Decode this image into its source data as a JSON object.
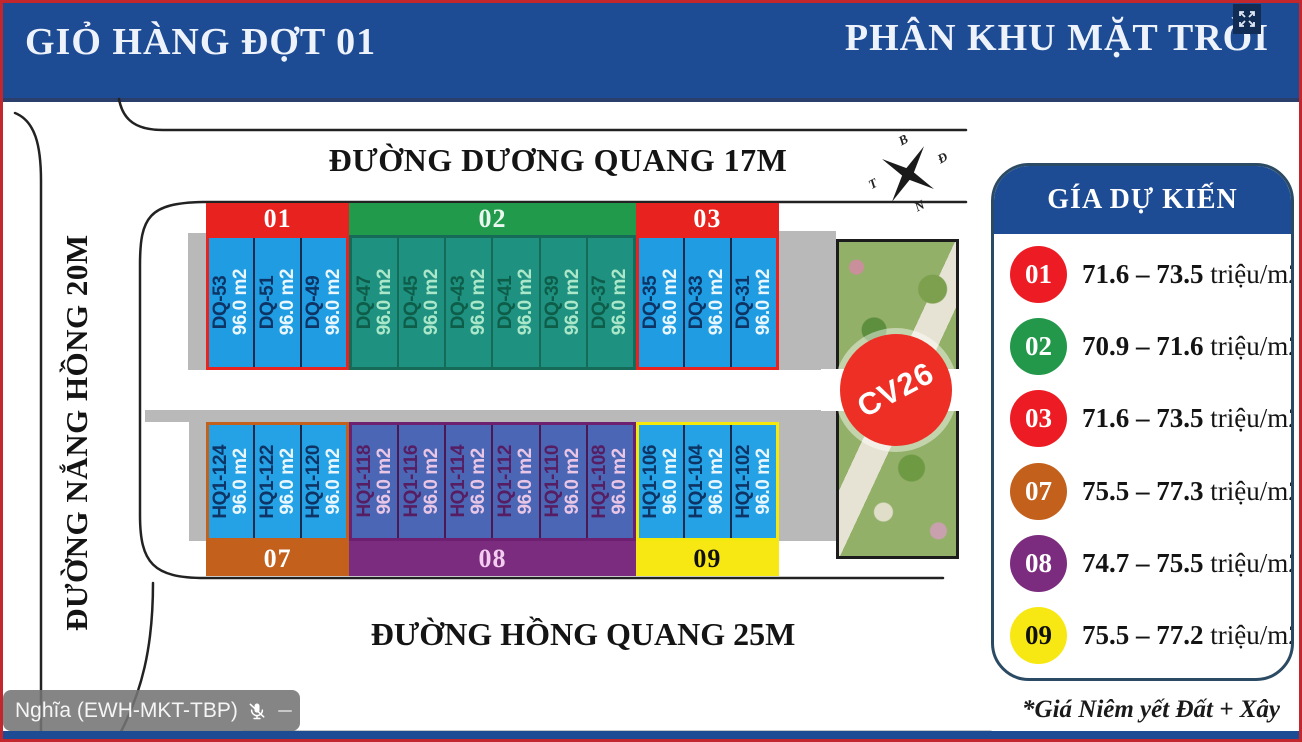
{
  "header": {
    "left_title": "GIỎ HÀNG ĐỢT 01",
    "right_title": "PHÂN KHU MẶT TRỜI"
  },
  "streets": {
    "top": "ĐƯỜNG DƯƠNG QUANG 17M",
    "left": "ĐƯỜNG NẮNG HỒNG 20M",
    "bottom": "ĐƯỜNG HỒNG QUANG 25M"
  },
  "compass": {
    "top": "B",
    "right": "Đ",
    "bottom": "N",
    "left": "T"
  },
  "park": {
    "label": "CV26",
    "marker_color": "#ee2f25"
  },
  "blocks": {
    "row1": [
      {
        "id": "01",
        "header_color": "#e8221f",
        "header_text": "#ffffff",
        "plot_bg": "#1f9ce2",
        "code_color": "#0d3464",
        "area_color": "#eaf7ff",
        "border_color": "#e8221f",
        "divider": "#1a2c4e",
        "plots": [
          {
            "code": "DQ-53",
            "area": "96.0 m2"
          },
          {
            "code": "DQ-51",
            "area": "96.0 m2"
          },
          {
            "code": "DQ-49",
            "area": "96.0 m2"
          }
        ]
      },
      {
        "id": "02",
        "header_color": "#219a4b",
        "header_text": "#e9f7ee",
        "plot_bg": "#1f9180",
        "code_color": "#0e5d49",
        "area_color": "#abe7c9",
        "border_color": "#156b57",
        "divider": "#156b57",
        "plots": [
          {
            "code": "DQ-47",
            "area": "96.0 m2"
          },
          {
            "code": "DQ-45",
            "area": "96.0 m2"
          },
          {
            "code": "DQ-43",
            "area": "96.0 m2"
          },
          {
            "code": "DQ-41",
            "area": "96.0 m2"
          },
          {
            "code": "DQ-39",
            "area": "96.0 m2"
          },
          {
            "code": "DQ-37",
            "area": "96.0 m2"
          }
        ]
      },
      {
        "id": "03",
        "header_color": "#e8221f",
        "header_text": "#ffffff",
        "plot_bg": "#1f9ce2",
        "code_color": "#0d3464",
        "area_color": "#eaf7ff",
        "border_color": "#e8221f",
        "divider": "#1a2c4e",
        "plots": [
          {
            "code": "DQ-35",
            "area": "96.0 m2"
          },
          {
            "code": "DQ-33",
            "area": "96.0 m2"
          },
          {
            "code": "DQ-31",
            "area": "96.0 m2"
          }
        ]
      }
    ],
    "row2": [
      {
        "id": "07",
        "header_color": "#c2601c",
        "header_text": "#ffffff",
        "plot_bg": "#25a2e5",
        "code_color": "#0d3464",
        "area_color": "#eaf7ff",
        "border_color": "#c2601c",
        "divider": "#1a2c4e",
        "plots": [
          {
            "code": "HQ1-124",
            "area": "96.0 m2"
          },
          {
            "code": "HQ1-122",
            "area": "96.0 m2"
          },
          {
            "code": "HQ1-120",
            "area": "96.0 m2"
          }
        ]
      },
      {
        "id": "08",
        "header_color": "#7c2c7e",
        "header_text": "#f2cdef",
        "plot_bg": "#4b66b5",
        "code_color": "#571d62",
        "area_color": "#e9c6e6",
        "border_color": "#6d2070",
        "divider": "#4a1853",
        "plots": [
          {
            "code": "HQ1-118",
            "area": "96.0 m2"
          },
          {
            "code": "HQ1-116",
            "area": "96.0 m2"
          },
          {
            "code": "HQ1-114",
            "area": "96.0 m2"
          },
          {
            "code": "HQ1-112",
            "area": "96.0 m2"
          },
          {
            "code": "HQ1-110",
            "area": "96.0 m2"
          },
          {
            "code": "HQ1-108",
            "area": "96.0 m2"
          }
        ]
      },
      {
        "id": "09",
        "header_color": "#f7e813",
        "header_text": "#101010",
        "plot_bg": "#25a2e5",
        "code_color": "#0d3464",
        "area_color": "#eaf7ff",
        "border_color": "#f5e90c",
        "divider": "#1a2c4e",
        "plots": [
          {
            "code": "HQ1-106",
            "area": "96.0 m2"
          },
          {
            "code": "HQ1-104",
            "area": "96.0 m2"
          },
          {
            "code": "HQ1-102",
            "area": "96.0 m2"
          }
        ]
      }
    ]
  },
  "legend": {
    "title": "GÍA DỰ KIẾN",
    "items": [
      {
        "id": "01",
        "color": "#ed1c24",
        "text_color": "#ffffff",
        "range": "71.6 – 73.5",
        "unit": "triệu/m2"
      },
      {
        "id": "02",
        "color": "#23984a",
        "text_color": "#ffffff",
        "range": "70.9 – 71.6",
        "unit": "triệu/m2"
      },
      {
        "id": "03",
        "color": "#ed1c24",
        "text_color": "#ffffff",
        "range": "71.6 – 73.5",
        "unit": "triệu/m2"
      },
      {
        "id": "07",
        "color": "#c2601c",
        "text_color": "#ffffff",
        "range": "75.5 – 77.3",
        "unit": "triệu/m2"
      },
      {
        "id": "08",
        "color": "#7c2c7e",
        "text_color": "#ffffff",
        "range": "74.7 – 75.5",
        "unit": "triệu/m2"
      },
      {
        "id": "09",
        "color": "#f7e813",
        "text_color": "#101010",
        "range": "75.5 – 77.2",
        "unit": "triệu/m2"
      }
    ],
    "footnote": "*Giá Niêm yết Đất + Xây"
  },
  "overlay": {
    "participant": "Nghĩa (EWH-MKT-TBP)"
  }
}
